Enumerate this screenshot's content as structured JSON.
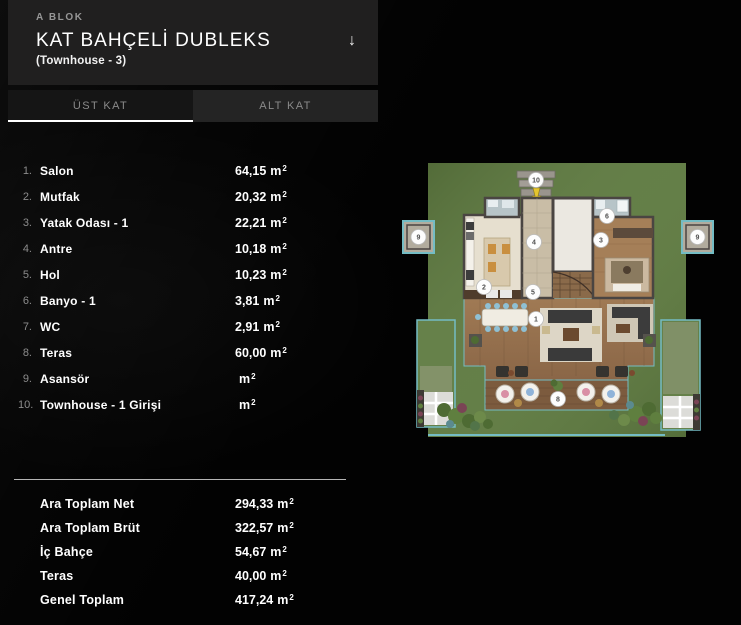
{
  "header": {
    "block": "A BLOK",
    "title": "KAT BAHÇELİ DUBLEKS",
    "subtitle": "(Townhouse - 3)",
    "dropdown_icon": "↓"
  },
  "tabs": [
    {
      "label": "ÜST KAT",
      "active": true
    },
    {
      "label": "ALT KAT",
      "active": false
    }
  ],
  "unit": {
    "base": "m",
    "sup": "2"
  },
  "rooms": [
    {
      "no": "1.",
      "label": "Salon",
      "value": "64,15"
    },
    {
      "no": "2.",
      "label": "Mutfak",
      "value": "20,32"
    },
    {
      "no": "3.",
      "label": "Yatak Odası - 1",
      "value": "22,21"
    },
    {
      "no": "4.",
      "label": "Antre",
      "value": "10,18"
    },
    {
      "no": "5.",
      "label": "Hol",
      "value": "10,23"
    },
    {
      "no": "6.",
      "label": "Banyo - 1",
      "value": "3,81"
    },
    {
      "no": "7.",
      "label": "WC",
      "value": "2,91"
    },
    {
      "no": "8.",
      "label": "Teras",
      "value": "60,00"
    },
    {
      "no": "9.",
      "label": "Asansör",
      "value": ""
    },
    {
      "no": "10.",
      "label": "Townhouse - 1 Girişi",
      "value": ""
    }
  ],
  "summary": [
    {
      "label": "Ara Toplam Net",
      "value": "294,33"
    },
    {
      "label": "Ara Toplam Brüt",
      "value": "322,57"
    },
    {
      "label": "İç Bahçe",
      "value": "54,67"
    },
    {
      "label": "Teras",
      "value": "40,00"
    },
    {
      "label": "Genel Toplam",
      "value": "417,24"
    }
  ],
  "floorplan": {
    "markers": [
      "10",
      "9",
      "9",
      "6",
      "3",
      "4",
      "2",
      "5",
      "1",
      "8"
    ],
    "colors": {
      "grass": "#5e7a40",
      "garden_grass": "#66814a",
      "teal": "#74bcc4",
      "wood": "#96714e",
      "terrace_wood": "#7c5b3e",
      "wall": "#4a4542",
      "tile": "#c9bda6",
      "kitchen": "#e6dfcf",
      "white_room": "#ebe8e1",
      "bath": "#b7c4c8",
      "arrow": "#e5c52e"
    }
  }
}
